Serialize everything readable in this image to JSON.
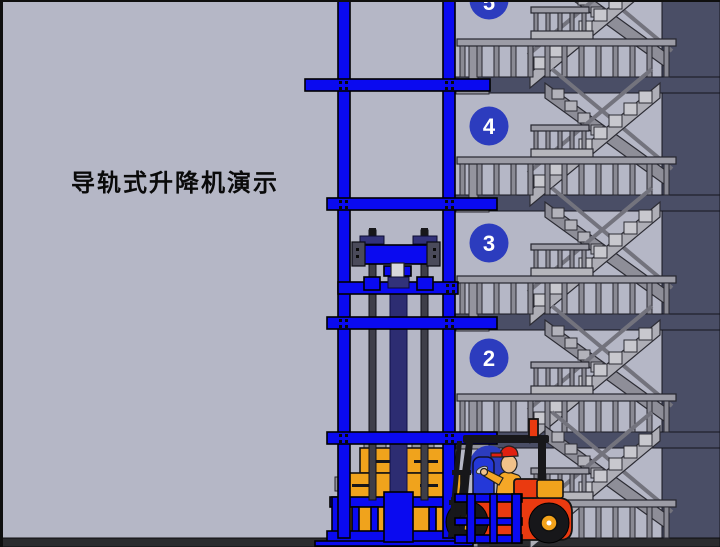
{
  "title": "导轨式升降机演示",
  "floors": {
    "labels": [
      "5",
      "4",
      "3",
      "2",
      "1"
    ]
  },
  "colors": {
    "background": "#b5b7c6",
    "wall_dark": "#4a4e66",
    "structure_blue": "#0a0af0",
    "floor_badge": "#2c3cbe",
    "ground": "#2b2b2e",
    "forklift_red": "#ea3a10",
    "cargo_orange": "#f0a31c",
    "wheel_hub": "#f2a21a",
    "stair_gray": "#aeaeb6"
  }
}
